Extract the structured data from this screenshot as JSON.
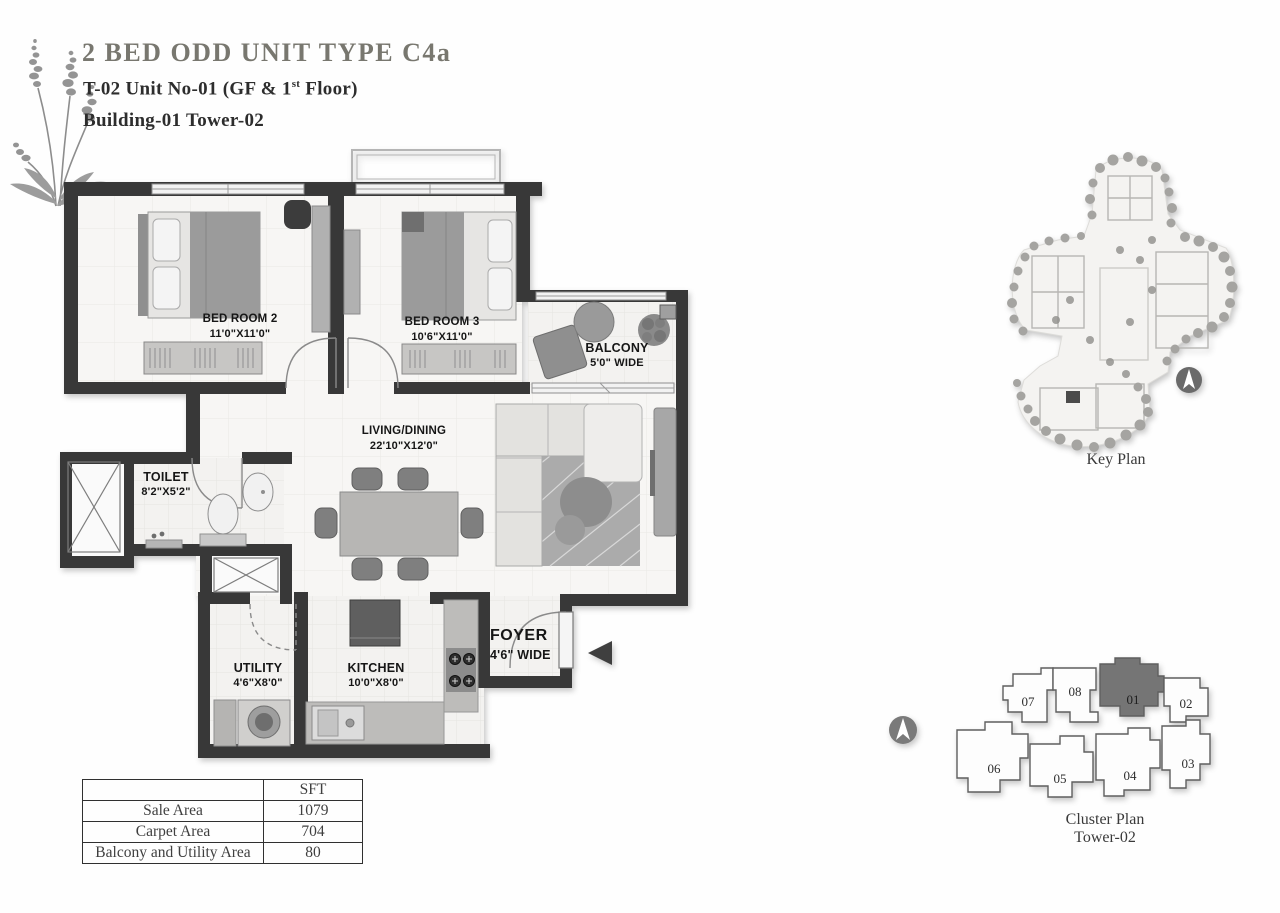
{
  "header": {
    "title": "2 BED ODD UNIT  TYPE C4a",
    "unit_line_prefix": "T-02 Unit No-01 (GF & 1",
    "unit_line_sup": "st",
    "unit_line_suffix": " Floor)",
    "building_line": "Building-01 Tower-02"
  },
  "floor_plan": {
    "rooms": [
      {
        "name": "BED ROOM 2",
        "dims": "11'0\"X11'0\""
      },
      {
        "name": "BED ROOM 3",
        "dims": "10'6\"X11'0\""
      },
      {
        "name": "BALCONY",
        "dims": "5'0\" WIDE"
      },
      {
        "name": "LIVING/DINING",
        "dims": "22'10\"X12'0\""
      },
      {
        "name": "TOILET",
        "dims": "8'2\"X5'2\""
      },
      {
        "name": "UTILITY",
        "dims": "4'6\"X8'0\""
      },
      {
        "name": "KITCHEN",
        "dims": "10'0\"X8'0\""
      },
      {
        "name": "FOYER",
        "dims": "4'6\" WIDE"
      }
    ]
  },
  "key_plan": {
    "caption": "Key Plan"
  },
  "cluster_plan": {
    "caption_line1": "Cluster Plan",
    "caption_line2": "Tower-02",
    "highlighted_unit": "01",
    "units": [
      {
        "label": "01"
      },
      {
        "label": "02"
      },
      {
        "label": "03"
      },
      {
        "label": "04"
      },
      {
        "label": "05"
      },
      {
        "label": "06"
      },
      {
        "label": "07"
      },
      {
        "label": "08"
      }
    ]
  },
  "area_table": {
    "unit_header": "SFT",
    "rows": [
      {
        "label": "Sale Area",
        "value": "1079"
      },
      {
        "label": "Carpet Area",
        "value": "704"
      },
      {
        "label": "Balcony and Utility Area",
        "value": "80"
      }
    ]
  },
  "colors": {
    "wall": "#383838",
    "title_text": "#78776f",
    "highlight_unit_fill": "#757575"
  }
}
